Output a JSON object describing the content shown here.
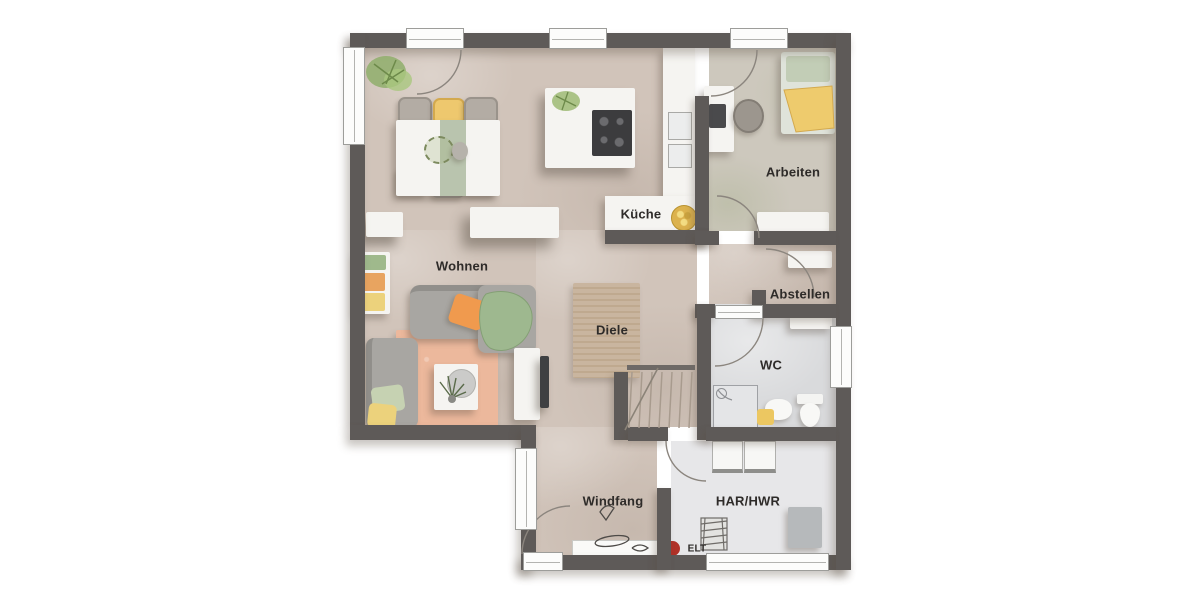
{
  "rooms": [
    {
      "id": "wohnen",
      "label": "Wohnen"
    },
    {
      "id": "kueche",
      "label": "Küche"
    },
    {
      "id": "arbeiten",
      "label": "Arbeiten"
    },
    {
      "id": "abstellen",
      "label": "Abstellen"
    },
    {
      "id": "diele",
      "label": "Diele"
    },
    {
      "id": "wc",
      "label": "WC"
    },
    {
      "id": "windfang",
      "label": "Windfang"
    },
    {
      "id": "har_hwr",
      "label": "HAR/HWR"
    },
    {
      "id": "elt",
      "label": "ELT"
    }
  ],
  "theme": {
    "wall": "#5e5a58",
    "floor": "#d1c4ba",
    "floor2": "#cdc8bd",
    "floorGray": "#d9dadc",
    "floorLight": "#e7e7e9",
    "text": "#2e2b29",
    "accentYellow": "#eec86e",
    "accentOrange": "#f09a4e",
    "accentGreen": "#a9bf97",
    "furnGray": "#a8a6a2",
    "rugWohnen": "#ecb89c",
    "rugDiele": "#c9b59f",
    "eltRed": "#b03228",
    "cooktop": "#3c3c3e"
  }
}
